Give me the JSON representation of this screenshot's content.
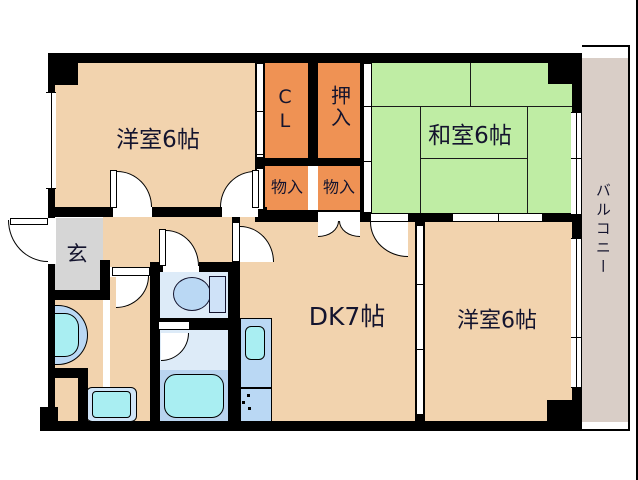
{
  "rooms": {
    "west_room_top": {
      "label": "洋室6帖"
    },
    "japanese_room": {
      "label": "和室6帖"
    },
    "west_room_bottom": {
      "label": "洋室6帖"
    },
    "dining_kitchen": {
      "label": "DK7帖"
    },
    "closet": {
      "label": "CL"
    },
    "oshiire": {
      "label": "押入"
    },
    "storage_1": {
      "label": "物入"
    },
    "storage_2": {
      "label": "物入"
    },
    "genkan": {
      "label": "玄"
    },
    "balcony": {
      "label": "バルコニー"
    }
  },
  "colors": {
    "wall": "#000000",
    "room_floor_beige": "#f2d3ae",
    "closet_orange": "#ef9254",
    "tatami_green": "#bfeda4",
    "genkan_gray": "#d6d6d6",
    "balcony_gray": "#d9cec7",
    "wet_area_floor": "#ddebf8",
    "fixture_blue": "#bad8f4",
    "fixture_cyan": "#a9eef2",
    "label_text": "#14142e"
  },
  "icons": [
    "toilet-icon",
    "bathtub-icon",
    "kitchen-sink-icon",
    "stove-burners-icon",
    "washbasin-icon",
    "washing-machine-pan-icon"
  ]
}
